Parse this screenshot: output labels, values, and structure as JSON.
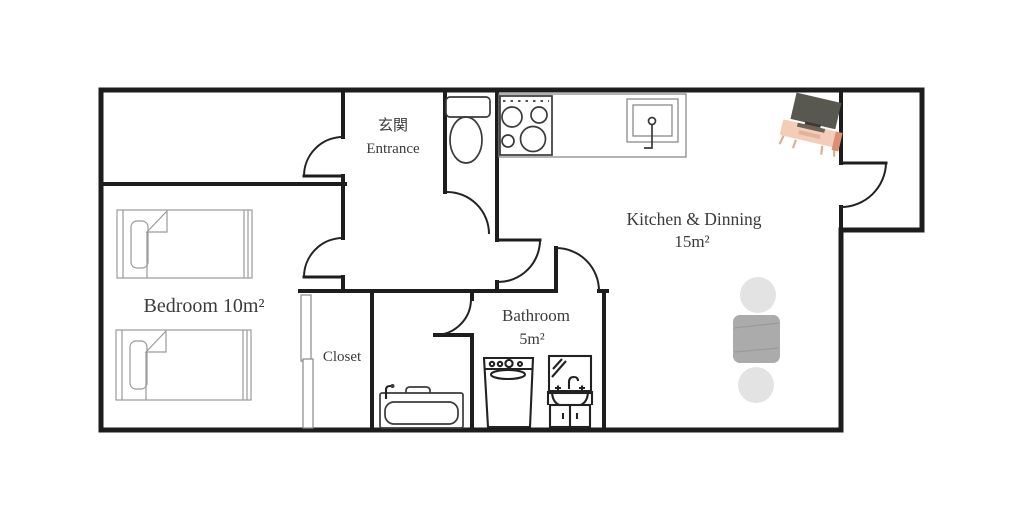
{
  "floorplan": {
    "rooms": {
      "entrance": {
        "label_ja": "玄関",
        "label_en": "Entrance"
      },
      "kitchen_dining": {
        "label": "Kitchen & Dinning",
        "area": "15m²"
      },
      "bedroom": {
        "label": "Bedroom 10m²"
      },
      "closet": {
        "label": "Closet"
      },
      "bathroom": {
        "label": "Bathroom",
        "area": "5m²"
      }
    },
    "furniture": {
      "bedroom": [
        "single-bed",
        "single-bed",
        "closet-sliding-door"
      ],
      "toilet_room": [
        "toilet"
      ],
      "kitchen_dining": [
        "gas-stove",
        "kitchen-counter-sink",
        "tv-on-stand",
        "dining-table",
        "chair",
        "chair"
      ],
      "bathroom": [
        "bathtub",
        "washing-machine",
        "vanity-sink-with-mirror"
      ]
    },
    "colors": {
      "wall": "#1d1d1d",
      "table": "#ababab",
      "chair": "#e3e3e3",
      "tv_screen": "#585750",
      "tv_stand": "#f3cdb8",
      "tv_stand_side": "#d98e76",
      "tv_base": "#3b3a35",
      "background": "#ffffff"
    }
  }
}
